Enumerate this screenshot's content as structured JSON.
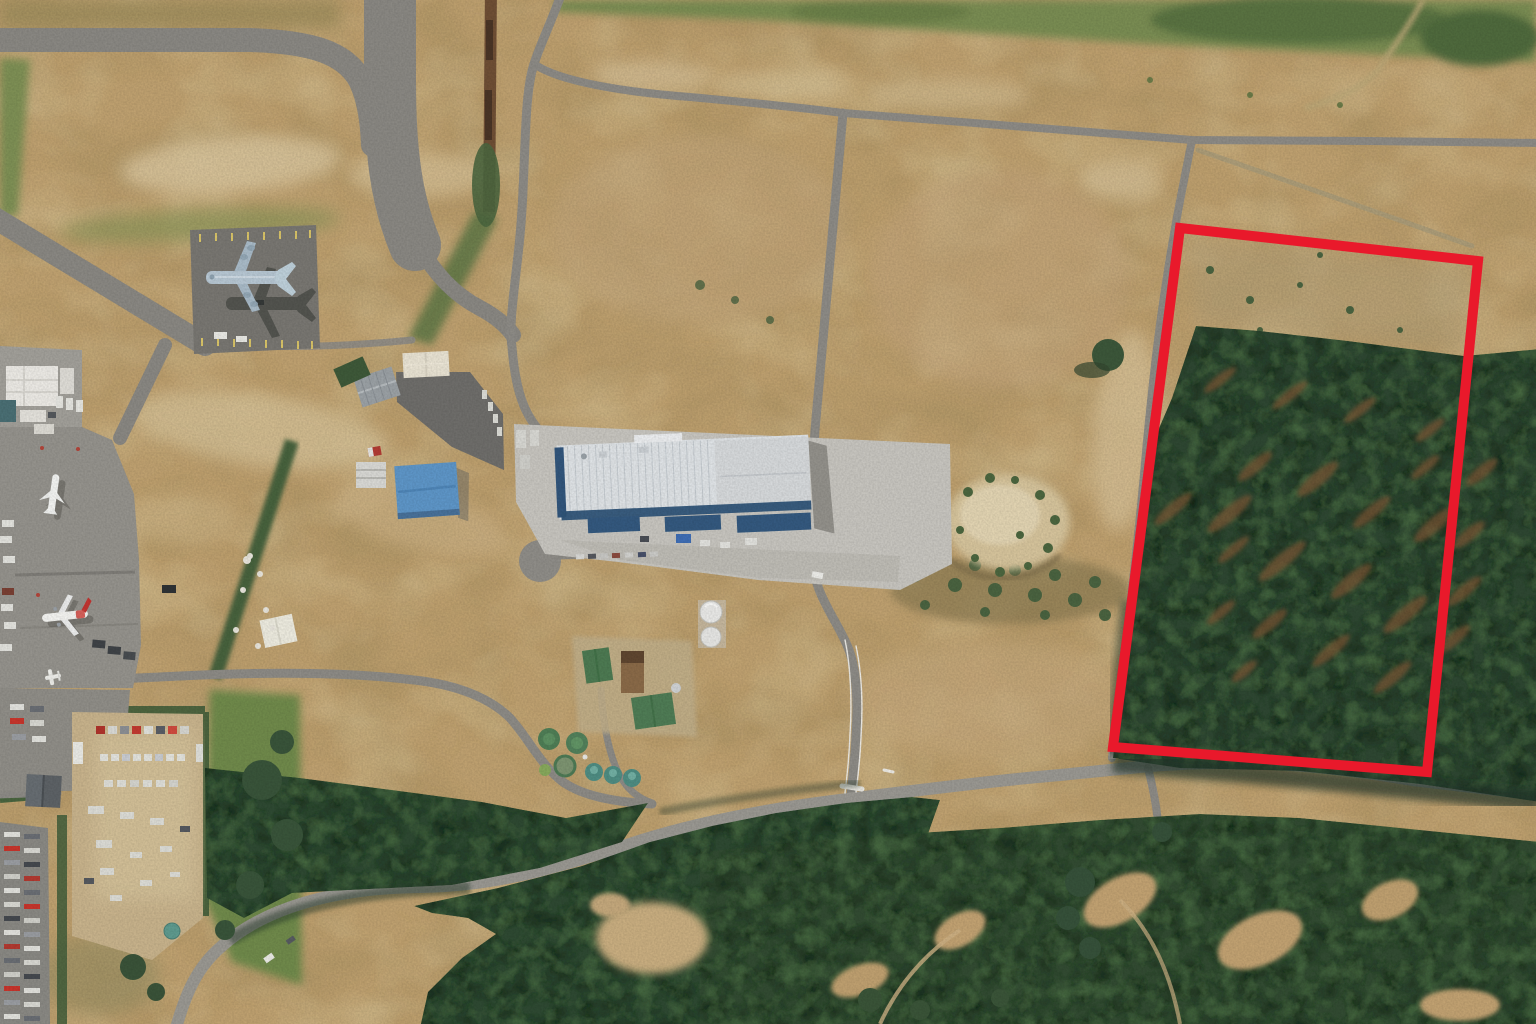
{
  "meta": {
    "title": "Aerial photograph of an airfield precinct with a red boundary highlighting a forested parcel",
    "width_px": 1536,
    "height_px": 1024,
    "visible_text": "none"
  },
  "annotation": {
    "name": "parcel-boundary",
    "shape": "quadrilateral",
    "outline_points": "1180,228 1478,261 1427,772 1113,747",
    "color": "#e9192b",
    "stroke_width_px": 10
  },
  "palette": {
    "dry_grass": "#bfa170",
    "dirt_light": "#d2bd8f",
    "road_asphalt": "#8d8b86",
    "apron_concrete": "#c7c5bf",
    "dark_asphalt": "#797772",
    "forest_dark": "#2f4a31",
    "forest_rust": "#7b5634",
    "grass_green": "#7a8d52",
    "factory_roof": "#dfe3e6",
    "factory_trim": "#2f5478",
    "blue_roof": "#5e96c8",
    "tank_green": "#4f7e56",
    "tank_teal": "#4f8d83",
    "red_annotation": "#e9192b"
  },
  "features": {
    "aircraft": [
      {
        "name": "military-transport-aircraft",
        "cx": 248,
        "cy": 278
      },
      {
        "name": "white-airliner",
        "cx": 53,
        "cy": 494
      },
      {
        "name": "red-tail-airliner",
        "cx": 64,
        "cy": 616
      },
      {
        "name": "light-aircraft",
        "cx": 52,
        "cy": 677
      }
    ],
    "buildings": [
      {
        "name": "large-white-factory",
        "x": 558,
        "y": 437
      },
      {
        "name": "blue-roof-building",
        "x": 396,
        "y": 464
      },
      {
        "name": "gray-barn",
        "x": 357,
        "y": 372
      },
      {
        "name": "cream-shed",
        "x": 403,
        "y": 352
      },
      {
        "name": "water-treatment-plant",
        "x": 580,
        "y": 640
      },
      {
        "name": "dark-gable-building",
        "x": 26,
        "y": 775
      }
    ],
    "water_tanks": {
      "green_round": 3,
      "teal_round": 3,
      "white_round": 2
    },
    "parking_areas": [
      "west-apron",
      "southwest-vehicle-lot",
      "storage-yard"
    ],
    "landscape": [
      "taxiways-northwest",
      "dry-grass-fields-center",
      "pine-forest-south-and-east",
      "eroded-gully-east-of-factory",
      "green-lawn-bottom-center"
    ]
  }
}
